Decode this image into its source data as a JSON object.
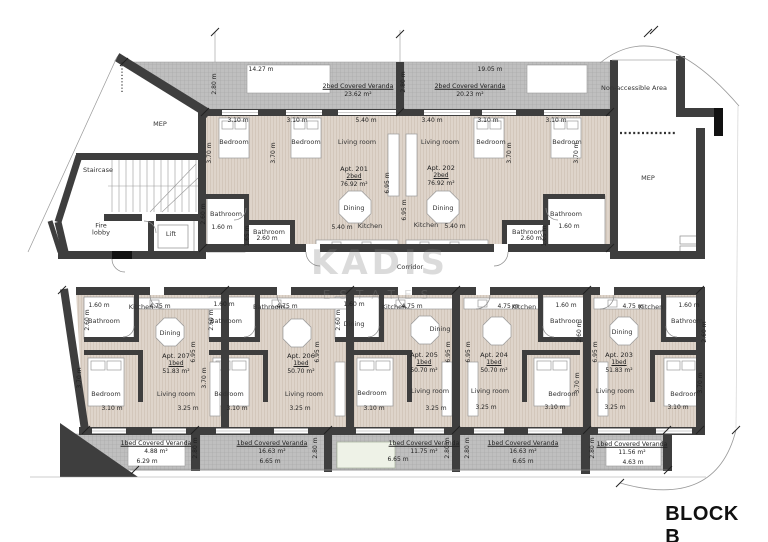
{
  "title": "BLOCK B",
  "watermark": {
    "line1": "KADIS",
    "line2": "ESTATES"
  },
  "colors": {
    "wall": "#3e3e3e",
    "floor": "#ded4ca",
    "floor_stripe": "#cfc2b5",
    "veranda": "#bfbfbf",
    "veranda_grid": "#a5a5a5",
    "text": "#1f1f1f",
    "watermark": "#9a9a9a",
    "planter": "#eef2e7"
  },
  "apartments": [
    {
      "id": "Apt. 201",
      "type": "2bed",
      "area": "76.92 m²",
      "x": 354,
      "y": 177
    },
    {
      "id": "Apt. 202",
      "type": "2bed",
      "area": "76.92 m²",
      "x": 441,
      "y": 176
    },
    {
      "id": "Apt. 207",
      "type": "1bed",
      "area": "51.83 m²",
      "x": 176,
      "y": 364
    },
    {
      "id": "Apt. 206",
      "type": "1bed",
      "area": "50.70 m²",
      "x": 301,
      "y": 364
    },
    {
      "id": "Apt. 205",
      "type": "1bed",
      "area": "50.70 m²",
      "x": 424,
      "y": 363
    },
    {
      "id": "Apt. 204",
      "type": "1bed",
      "area": "50.70 m²",
      "x": 494,
      "y": 363
    },
    {
      "id": "Apt. 203",
      "type": "1bed",
      "area": "51.83 m²",
      "x": 619,
      "y": 363
    }
  ],
  "verandas": [
    {
      "label": "2bed Covered Veranda",
      "area": "23.62 m²",
      "x": 358,
      "y": 91
    },
    {
      "label": "2bed Covered Veranda",
      "area": "20.23 m²",
      "x": 470,
      "y": 91
    },
    {
      "label": "1bed Covered Veranda",
      "area": "4.88 m²",
      "x": 156,
      "y": 448,
      "dim": "6.29 m",
      "dx": 147,
      "dy": 462
    },
    {
      "label": "1bed Covered Veranda",
      "area": "16.63 m²",
      "x": 272,
      "y": 448,
      "dim": "6.65 m",
      "dx": 270,
      "dy": 462
    },
    {
      "label": "1bed Covered Veranda",
      "area": "11.75 m²",
      "x": 424,
      "y": 448,
      "dim": "6.65 m",
      "dx": 398,
      "dy": 460
    },
    {
      "label": "1bed Covered Veranda",
      "area": "16.63 m²",
      "x": 523,
      "y": 448,
      "dim": "6.65 m",
      "dx": 523,
      "dy": 462
    },
    {
      "label": "1bed Covered Veranda",
      "area": "11.56 m²",
      "x": 632,
      "y": 449,
      "dim": "4.63 m",
      "dx": 633,
      "dy": 463
    }
  ],
  "rooms": [
    {
      "t": "MEP",
      "x": 160,
      "y": 124
    },
    {
      "t": "Staircase",
      "x": 98,
      "y": 170
    },
    {
      "t": "Fire lobby",
      "x": 101,
      "y": 230,
      "w": 26
    },
    {
      "t": "Lift",
      "x": 171,
      "y": 234
    },
    {
      "t": "Bedroom",
      "x": 234,
      "y": 142
    },
    {
      "t": "Bedroom",
      "x": 306,
      "y": 142
    },
    {
      "t": "Living room",
      "x": 357,
      "y": 142
    },
    {
      "t": "Dining",
      "x": 354,
      "y": 208
    },
    {
      "t": "Kitchen",
      "x": 370,
      "y": 226
    },
    {
      "t": "Bathroom",
      "x": 226,
      "y": 214
    },
    {
      "t": "Bathroom",
      "x": 269,
      "y": 232
    },
    {
      "t": "Living room",
      "x": 440,
      "y": 142
    },
    {
      "t": "Bedroom",
      "x": 491,
      "y": 142
    },
    {
      "t": "Bedroom",
      "x": 567,
      "y": 142
    },
    {
      "t": "Dining",
      "x": 443,
      "y": 208
    },
    {
      "t": "Kitchen",
      "x": 426,
      "y": 225
    },
    {
      "t": "Bathroom",
      "x": 528,
      "y": 232
    },
    {
      "t": "Bathroom",
      "x": 566,
      "y": 214
    },
    {
      "t": "Non-accessible Area",
      "x": 634,
      "y": 88
    },
    {
      "t": "MEP",
      "x": 648,
      "y": 178
    },
    {
      "t": "Corridor",
      "x": 410,
      "y": 267
    },
    {
      "t": "Bathroom",
      "x": 104,
      "y": 321
    },
    {
      "t": "Kitchen",
      "x": 141,
      "y": 307
    },
    {
      "t": "Dining",
      "x": 170,
      "y": 333
    },
    {
      "t": "Bedroom",
      "x": 106,
      "y": 394
    },
    {
      "t": "Living room",
      "x": 176,
      "y": 394
    },
    {
      "t": "Bathroom",
      "x": 226,
      "y": 321
    },
    {
      "t": "Bathroom",
      "x": 269,
      "y": 307
    },
    {
      "t": "Bedroom",
      "x": 229,
      "y": 394
    },
    {
      "t": "Living room",
      "x": 304,
      "y": 394
    },
    {
      "t": "Dining",
      "x": 354,
      "y": 324
    },
    {
      "t": "Kitchen",
      "x": 394,
      "y": 307
    },
    {
      "t": "Dining",
      "x": 440,
      "y": 329
    },
    {
      "t": "Bedroom",
      "x": 372,
      "y": 393
    },
    {
      "t": "Living room",
      "x": 430,
      "y": 391
    },
    {
      "t": "Kitchen",
      "x": 524,
      "y": 307
    },
    {
      "t": "Bathroom",
      "x": 566,
      "y": 321
    },
    {
      "t": "Living room",
      "x": 490,
      "y": 391
    },
    {
      "t": "Bedroom",
      "x": 563,
      "y": 394
    },
    {
      "t": "Kitchen",
      "x": 651,
      "y": 307
    },
    {
      "t": "Dining",
      "x": 622,
      "y": 332
    },
    {
      "t": "Bathroom",
      "x": 687,
      "y": 321
    },
    {
      "t": "Living room",
      "x": 615,
      "y": 391
    },
    {
      "t": "Bedroom",
      "x": 685,
      "y": 394
    }
  ],
  "dims": [
    {
      "t": "14.27 m",
      "x": 261,
      "y": 70
    },
    {
      "t": "19.05 m",
      "x": 490,
      "y": 70
    },
    {
      "t": "2.80 m",
      "x": 215,
      "y": 84,
      "v": 1
    },
    {
      "t": "2.80 m",
      "x": 404,
      "y": 82,
      "v": 1
    },
    {
      "t": "3.10 m",
      "x": 238,
      "y": 121
    },
    {
      "t": "3.10 m",
      "x": 297,
      "y": 121
    },
    {
      "t": "5.40 m",
      "x": 366,
      "y": 121
    },
    {
      "t": "3.40 m",
      "x": 432,
      "y": 121
    },
    {
      "t": "3.10 m",
      "x": 488,
      "y": 121
    },
    {
      "t": "3.10 m",
      "x": 556,
      "y": 121
    },
    {
      "t": "3.70 m",
      "x": 210,
      "y": 153,
      "v": 1
    },
    {
      "t": "3.70 m",
      "x": 274,
      "y": 153,
      "v": 1
    },
    {
      "t": "3.70 m",
      "x": 510,
      "y": 153,
      "v": 1
    },
    {
      "t": "3.70 m",
      "x": 577,
      "y": 153,
      "v": 1
    },
    {
      "t": "6.95 m",
      "x": 388,
      "y": 183,
      "v": 1
    },
    {
      "t": "6.95 m",
      "x": 405,
      "y": 210,
      "v": 1
    },
    {
      "t": "2.60 m",
      "x": 204,
      "y": 214,
      "v": 1
    },
    {
      "t": "1.60 m",
      "x": 222,
      "y": 228
    },
    {
      "t": "2.60 m",
      "x": 267,
      "y": 239
    },
    {
      "t": "5.40 m",
      "x": 342,
      "y": 228
    },
    {
      "t": "1.65 m",
      "x": 248,
      "y": 236,
      "v": 1
    },
    {
      "t": "5.40 m",
      "x": 455,
      "y": 227
    },
    {
      "t": "2.60 m",
      "x": 531,
      "y": 239
    },
    {
      "t": "1.60 m",
      "x": 569,
      "y": 227
    },
    {
      "t": "1.65 m",
      "x": 545,
      "y": 236,
      "v": 1
    },
    {
      "t": "1.60 m",
      "x": 99,
      "y": 306
    },
    {
      "t": "2.60 m",
      "x": 88,
      "y": 320,
      "v": 1
    },
    {
      "t": "4.75 m",
      "x": 160,
      "y": 307
    },
    {
      "t": "3.10 m",
      "x": 112,
      "y": 409
    },
    {
      "t": "3.25 m",
      "x": 188,
      "y": 409
    },
    {
      "t": "3.70 m",
      "x": 80,
      "y": 378,
      "v": 1
    },
    {
      "t": "6.95 m",
      "x": 194,
      "y": 352,
      "v": 1
    },
    {
      "t": "1.60 m",
      "x": 224,
      "y": 305
    },
    {
      "t": "2.60 m",
      "x": 212,
      "y": 320,
      "v": 1
    },
    {
      "t": "4.75 m",
      "x": 287,
      "y": 307
    },
    {
      "t": "3.10 m",
      "x": 237,
      "y": 409
    },
    {
      "t": "3.25 m",
      "x": 300,
      "y": 409
    },
    {
      "t": "3.70 m",
      "x": 205,
      "y": 378,
      "v": 1
    },
    {
      "t": "6.95 m",
      "x": 318,
      "y": 352,
      "v": 1
    },
    {
      "t": "1.60 m",
      "x": 354,
      "y": 305
    },
    {
      "t": "2.60 m",
      "x": 339,
      "y": 320,
      "v": 1
    },
    {
      "t": "4.75 m",
      "x": 412,
      "y": 307
    },
    {
      "t": "3.10 m",
      "x": 374,
      "y": 409
    },
    {
      "t": "3.25 m",
      "x": 436,
      "y": 409
    },
    {
      "t": "6.95 m",
      "x": 449,
      "y": 352,
      "v": 1
    },
    {
      "t": "4.75 m",
      "x": 508,
      "y": 307
    },
    {
      "t": "1.60 m",
      "x": 566,
      "y": 306
    },
    {
      "t": "2.60 m",
      "x": 580,
      "y": 332,
      "v": 1
    },
    {
      "t": "3.25 m",
      "x": 486,
      "y": 408
    },
    {
      "t": "3.10 m",
      "x": 555,
      "y": 408
    },
    {
      "t": "3.70 m",
      "x": 578,
      "y": 383,
      "v": 1
    },
    {
      "t": "6.95 m",
      "x": 469,
      "y": 352,
      "v": 1
    },
    {
      "t": "4.75 m",
      "x": 633,
      "y": 307
    },
    {
      "t": "1.60 m",
      "x": 689,
      "y": 306
    },
    {
      "t": "2.60 m",
      "x": 705,
      "y": 332,
      "v": 1
    },
    {
      "t": "3.25 m",
      "x": 615,
      "y": 408
    },
    {
      "t": "3.10 m",
      "x": 678,
      "y": 408
    },
    {
      "t": "3.70 m",
      "x": 701,
      "y": 383,
      "v": 1
    },
    {
      "t": "6.95 m",
      "x": 596,
      "y": 352,
      "v": 1
    },
    {
      "t": "2.80 m",
      "x": 196,
      "y": 448,
      "v": 1
    },
    {
      "t": "2.80 m",
      "x": 316,
      "y": 448,
      "v": 1
    },
    {
      "t": "2.80 m",
      "x": 448,
      "y": 448,
      "v": 1
    },
    {
      "t": "2.80 m",
      "x": 468,
      "y": 448,
      "v": 1
    },
    {
      "t": "2.80 m",
      "x": 593,
      "y": 448,
      "v": 1
    }
  ]
}
